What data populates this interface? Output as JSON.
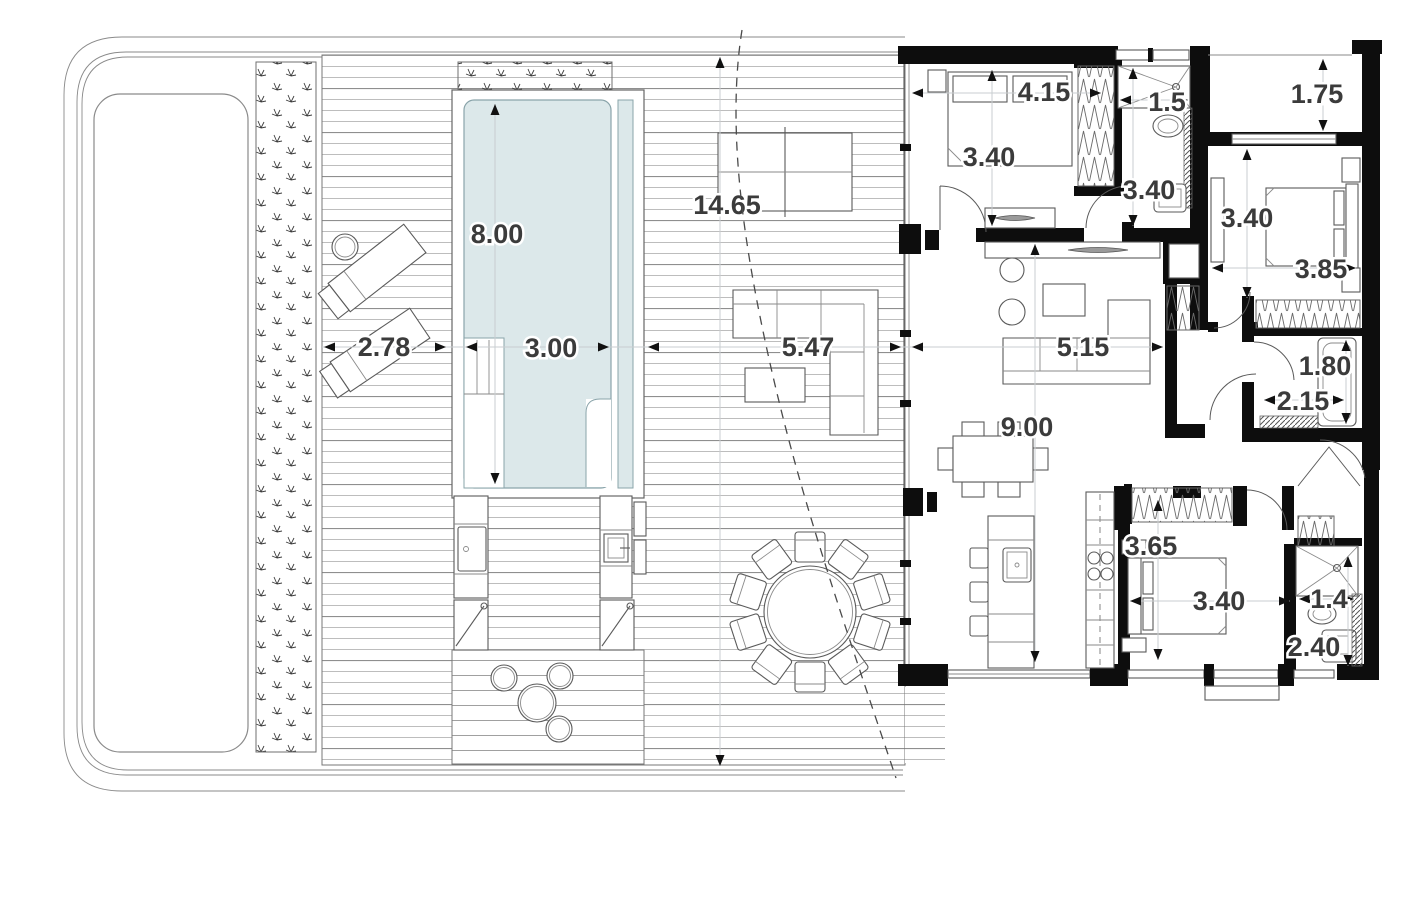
{
  "plan": {
    "type": "villa-floor-plan",
    "colors": {
      "wall": "#0d0d0d",
      "drawing_line": "#555555",
      "deck_line": "#9c9c9c",
      "pool_water_fill": "#dce8ea",
      "pool_water_edge": "#8aa4aa",
      "dim_text": "#3b3b3b",
      "faint_dim_line": "#c9cdd0",
      "background": "#ffffff"
    },
    "dimensions": {
      "outdoor": {
        "side_deck_width": "2.78",
        "pool_length": "8.00",
        "pool_width": "3.00",
        "deck_length": "14.65",
        "front_deck_width": "5.47"
      },
      "indoor": {
        "bedroom1_width": "4.15",
        "bedroom1_depth": "3.40",
        "shower1_width": "1.5",
        "bath1_depth": "3.40",
        "entry_patio_depth": "1.75",
        "bedroom2_depth": "3.40",
        "bedroom2_width": "3.85",
        "living_width": "5.15",
        "bath2_length": "1.80",
        "bath2_width": "2.15",
        "living_length": "9.00",
        "bedroom3_depth": "3.65",
        "bedroom3_bed_wall": "3.40",
        "shower3_width": "1.4",
        "bath3_length": "2.40"
      }
    }
  }
}
